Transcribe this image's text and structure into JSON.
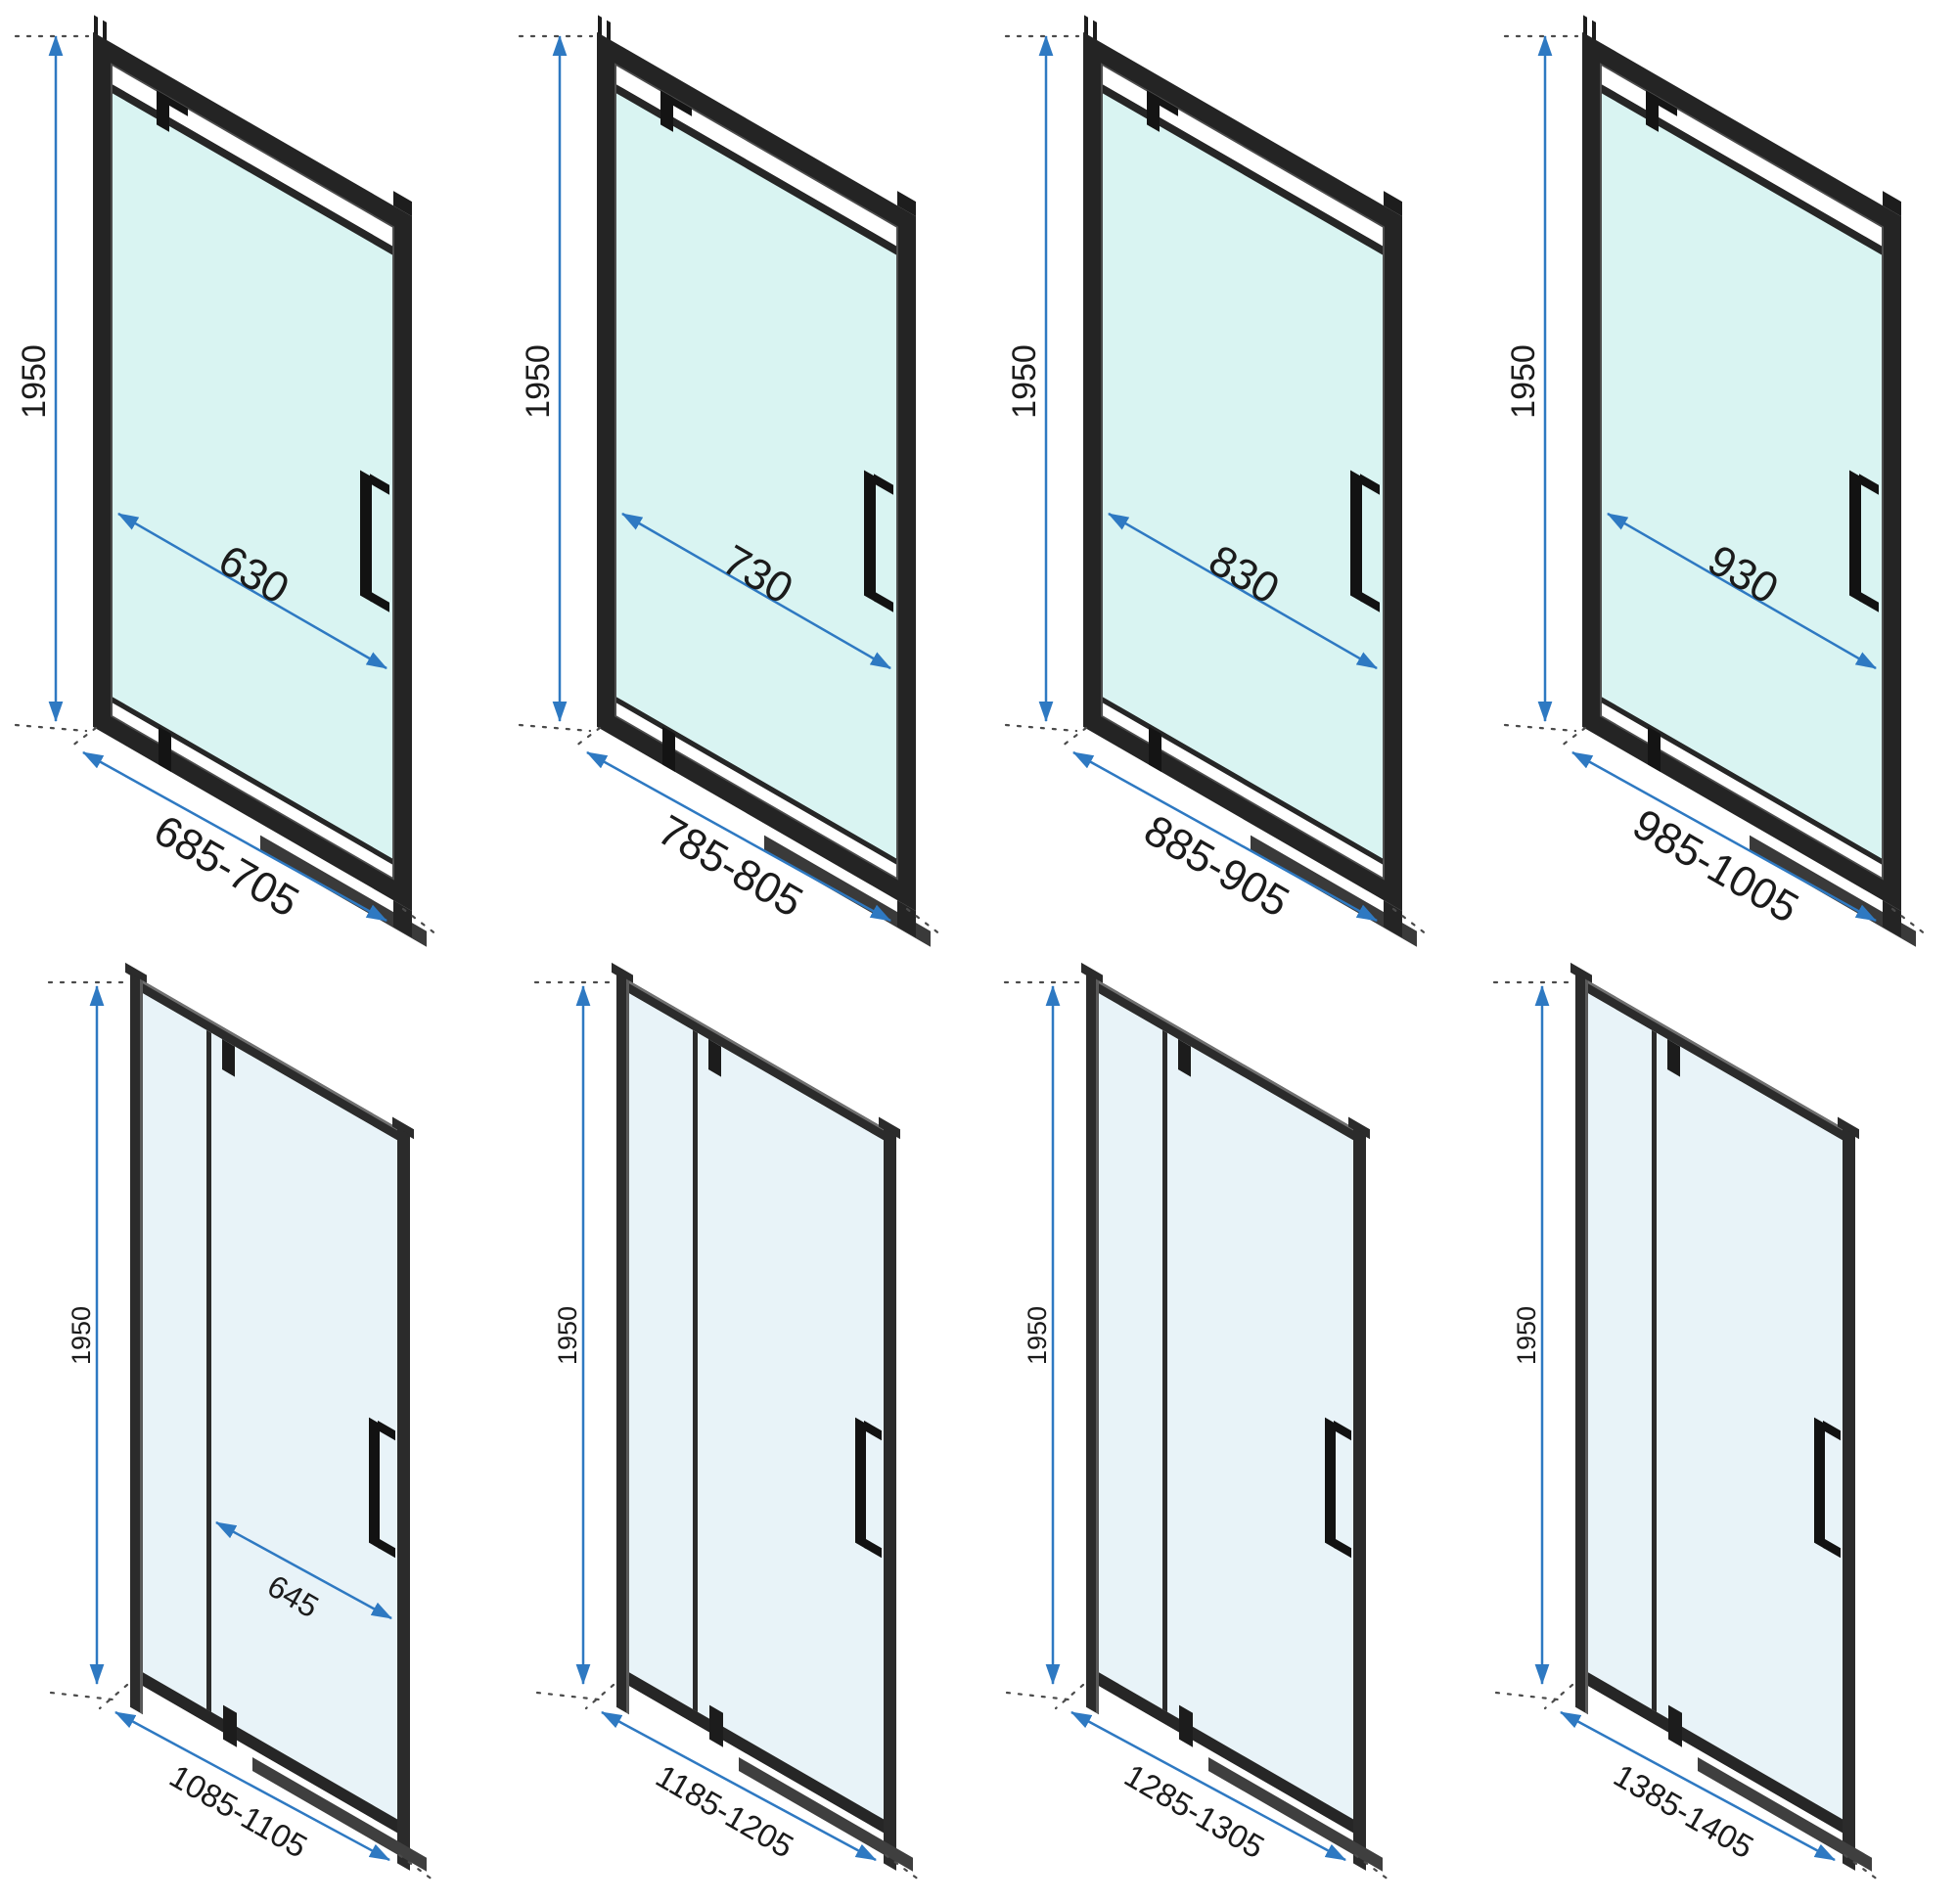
{
  "diagram": {
    "kind": "technical-dimension-diagram",
    "subject": "shower door size variants",
    "rows": [
      {
        "style": "framed sliding door, thick black profile",
        "count": 4
      },
      {
        "style": "slim profile door with fixed side panel",
        "count": 4
      }
    ]
  },
  "colors": {
    "dimension_blue": "#2e79c2",
    "frame_dark": "#242424",
    "frame_slim": "#2b2b2b",
    "glass_framed": "#d9f4f2",
    "glass_slim": "#e8f3f8",
    "label_text": "#1b1b1b",
    "background": "#ffffff"
  },
  "doors": [
    {
      "id": 1,
      "row": "top",
      "height_label": "1950",
      "opening_width_label": "630",
      "width_range_label": "685-705"
    },
    {
      "id": 2,
      "row": "top",
      "height_label": "1950",
      "opening_width_label": "730",
      "width_range_label": "785-805"
    },
    {
      "id": 3,
      "row": "top",
      "height_label": "1950",
      "opening_width_label": "830",
      "width_range_label": "885-905"
    },
    {
      "id": 4,
      "row": "top",
      "height_label": "1950",
      "opening_width_label": "930",
      "width_range_label": "985-1005"
    },
    {
      "id": 5,
      "row": "bottom",
      "height_label": "1950",
      "opening_width_label": "645",
      "width_range_label": "1085-1105"
    },
    {
      "id": 6,
      "row": "bottom",
      "height_label": "1950",
      "width_range_label": "1185-1205"
    },
    {
      "id": 7,
      "row": "bottom",
      "height_label": "1950",
      "width_range_label": "1285-1305"
    },
    {
      "id": 8,
      "row": "bottom",
      "height_label": "1950",
      "width_range_label": "1385-1405"
    }
  ]
}
